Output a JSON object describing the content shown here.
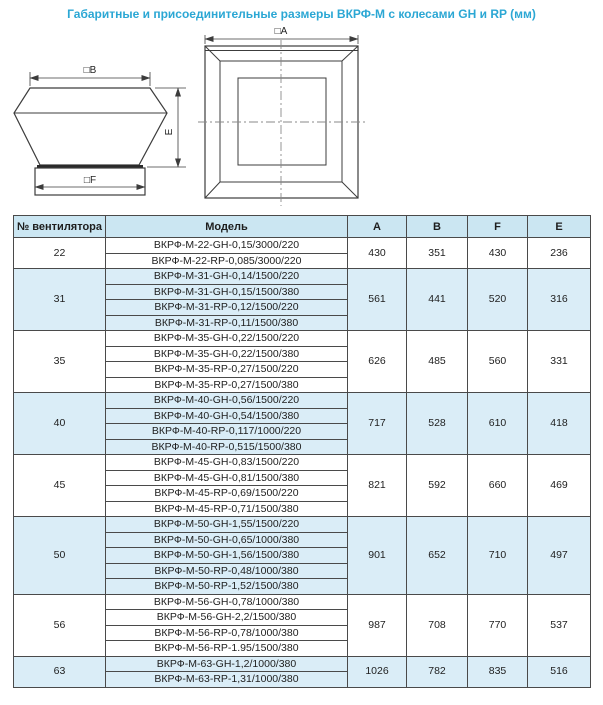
{
  "title": "Габаритные и присоединительные размеры ВКРФ-М с колесами GH и RP (мм)",
  "colors": {
    "accent_title": "#2ba7d4",
    "table_header_bg": "#cbe6f2",
    "row_stripe_bg": "#daedf7",
    "border": "#4a4a4a"
  },
  "diagram": {
    "side_view": {
      "label_b": "□B",
      "label_f": "□F",
      "label_e": "E"
    },
    "top_view": {
      "label_a": "□A"
    }
  },
  "table": {
    "headers": [
      "№ вентилятора",
      "Модель",
      "A",
      "B",
      "F",
      "E"
    ],
    "groups": [
      {
        "number": "22",
        "shaded": false,
        "models": [
          "ВКРФ-М-22-GH-0,15/3000/220",
          "ВКРФ-М-22-RP-0,085/3000/220"
        ],
        "A": "430",
        "B": "351",
        "F": "430",
        "E": "236"
      },
      {
        "number": "31",
        "shaded": true,
        "models": [
          "ВКРФ-М-31-GH-0,14/1500/220",
          "ВКРФ-М-31-GH-0,15/1500/380",
          "ВКРФ-М-31-RP-0,12/1500/220",
          "ВКРФ-М-31-RP-0,11/1500/380"
        ],
        "A": "561",
        "B": "441",
        "F": "520",
        "E": "316"
      },
      {
        "number": "35",
        "shaded": false,
        "models": [
          "ВКРФ-М-35-GH-0,22/1500/220",
          "ВКРФ-М-35-GH-0,22/1500/380",
          "ВКРФ-М-35-RP-0,27/1500/220",
          "ВКРФ-М-35-RP-0,27/1500/380"
        ],
        "A": "626",
        "B": "485",
        "F": "560",
        "E": "331"
      },
      {
        "number": "40",
        "shaded": true,
        "models": [
          "ВКРФ-М-40-GH-0,56/1500/220",
          "ВКРФ-М-40-GH-0,54/1500/380",
          "ВКРФ-М-40-RP-0,117/1000/220",
          "ВКРФ-М-40-RP-0,515/1500/380"
        ],
        "A": "717",
        "B": "528",
        "F": "610",
        "E": "418"
      },
      {
        "number": "45",
        "shaded": false,
        "models": [
          "ВКРФ-М-45-GH-0,83/1500/220",
          "ВКРФ-М-45-GH-0,81/1500/380",
          "ВКРФ-М-45-RP-0,69/1500/220",
          "ВКРФ-М-45-RP-0,71/1500/380"
        ],
        "A": "821",
        "B": "592",
        "F": "660",
        "E": "469"
      },
      {
        "number": "50",
        "shaded": true,
        "models": [
          "ВКРФ-М-50-GH-1,55/1500/220",
          "ВКРФ-М-50-GH-0,65/1000/380",
          "ВКРФ-М-50-GH-1,56/1500/380",
          "ВКРФ-М-50-RP-0,48/1000/380",
          "ВКРФ-М-50-RP-1,52/1500/380"
        ],
        "A": "901",
        "B": "652",
        "F": "710",
        "E": "497"
      },
      {
        "number": "56",
        "shaded": false,
        "models": [
          "ВКРФ-М-56-GH-0,78/1000/380",
          "ВКРФ-М-56-GH-2,2/1500/380",
          "ВКРФ-М-56-RP-0,78/1000/380",
          "ВКРФ-М-56-RP-1.95/1500/380"
        ],
        "A": "987",
        "B": "708",
        "F": "770",
        "E": "537"
      },
      {
        "number": "63",
        "shaded": true,
        "models": [
          "ВКРФ-М-63-GH-1,2/1000/380",
          "ВКРФ-М-63-RP-1,31/1000/380"
        ],
        "A": "1026",
        "B": "782",
        "F": "835",
        "E": "516"
      }
    ]
  }
}
